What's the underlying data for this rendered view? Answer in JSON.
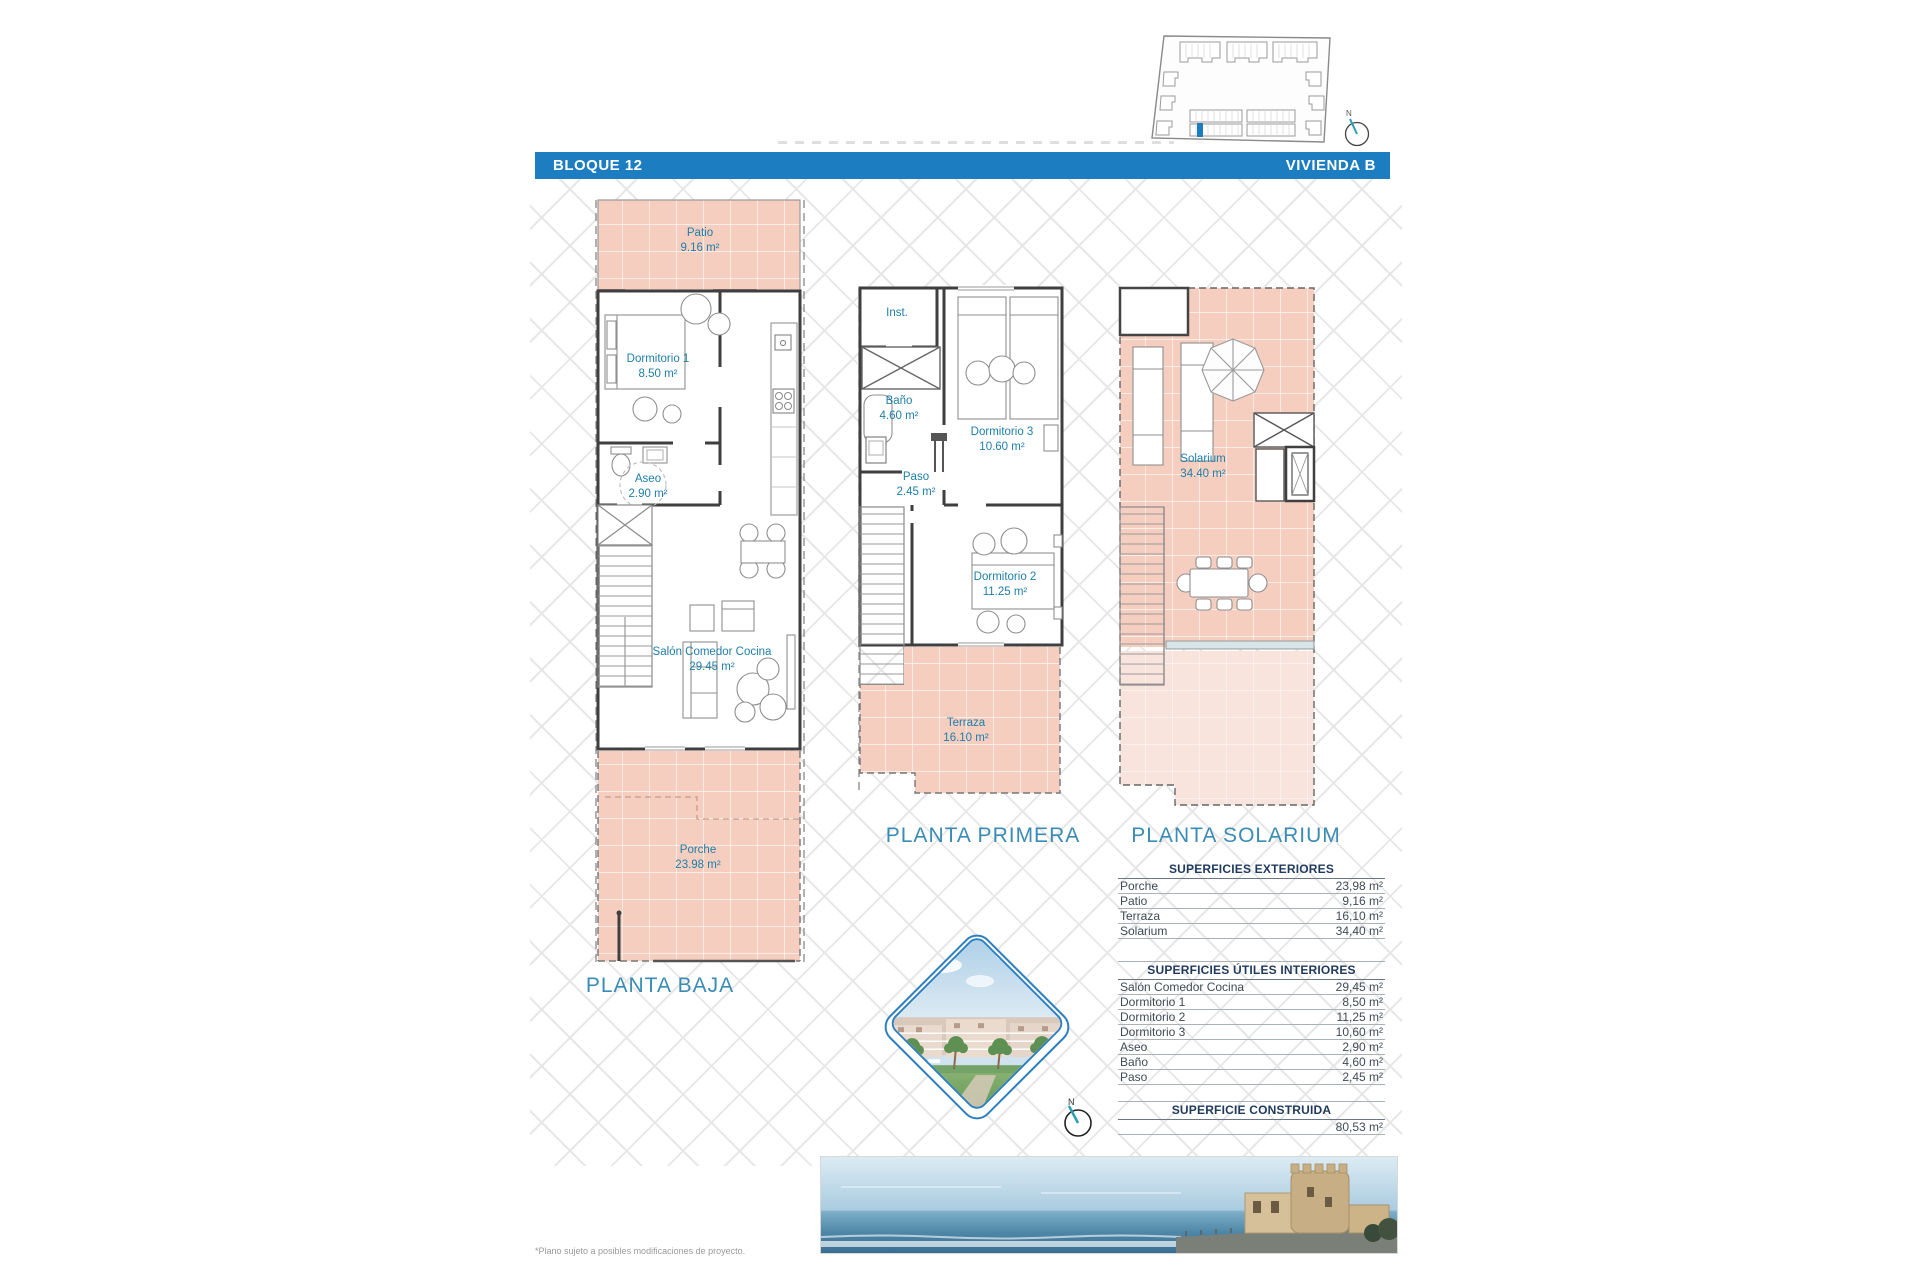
{
  "header": {
    "block": "BLOQUE 12",
    "unit": "VIVIENDA B"
  },
  "plans": {
    "baja": {
      "title": "PLANTA BAJA",
      "rooms": {
        "patio": {
          "name": "Patio",
          "area": "9.16 m²"
        },
        "dormitorio1": {
          "name": "Dormitorio 1",
          "area": "8.50 m²"
        },
        "aseo": {
          "name": "Aseo",
          "area": "2.90 m²"
        },
        "salon": {
          "name": "Salón Comedor Cocina",
          "area": "29.45 m²"
        },
        "porche": {
          "name": "Porche",
          "area": "23.98 m²"
        }
      }
    },
    "primera": {
      "title": "PLANTA PRIMERA",
      "rooms": {
        "inst": {
          "name": "Inst."
        },
        "bano": {
          "name": "Baño",
          "area": "4.60 m²"
        },
        "dormitorio3": {
          "name": "Dormitorio 3",
          "area": "10.60 m²"
        },
        "paso": {
          "name": "Paso",
          "area": "2.45 m²"
        },
        "dormitorio2": {
          "name": "Dormitorio 2",
          "area": "11.25 m²"
        },
        "terraza": {
          "name": "Terraza",
          "area": "16.10 m²"
        }
      }
    },
    "solarium": {
      "title": "PLANTA SOLARIUM",
      "rooms": {
        "solarium": {
          "name": "Solarium",
          "area": "34.40 m²"
        }
      }
    }
  },
  "tables": {
    "exteriores": {
      "title": "SUPERFICIES EXTERIORES",
      "rows": [
        {
          "label": "Porche",
          "value": "23,98 m²"
        },
        {
          "label": "Patio",
          "value": "9,16 m²"
        },
        {
          "label": "Terraza",
          "value": "16,10 m²"
        },
        {
          "label": "Solarium",
          "value": "34,40 m²"
        }
      ]
    },
    "interiores": {
      "title": "SUPERFICIES ÚTILES INTERIORES",
      "rows": [
        {
          "label": "Salón Comedor Cocina",
          "value": "29,45 m²"
        },
        {
          "label": "Dormitorio 1",
          "value": "8,50 m²"
        },
        {
          "label": "Dormitorio 2",
          "value": "11,25 m²"
        },
        {
          "label": "Dormitorio 3",
          "value": "10,60 m²"
        },
        {
          "label": "Aseo",
          "value": "2,90 m²"
        },
        {
          "label": "Baño",
          "value": "4,60 m²"
        },
        {
          "label": "Paso",
          "value": "2,45 m²"
        }
      ]
    },
    "construida": {
      "title": "SUPERFICIE CONSTRUIDA",
      "value": "80,53 m²"
    }
  },
  "compass": {
    "letter": "N"
  },
  "footnote": "*Plano sujeto a posibles modificaciones de proyecto.",
  "colors": {
    "accent_blue": "#1c7dc1",
    "label_blue": "#1f7ea9",
    "plan_pink": "#f5cec0",
    "plan_pink_light": "#f9e4dd"
  }
}
